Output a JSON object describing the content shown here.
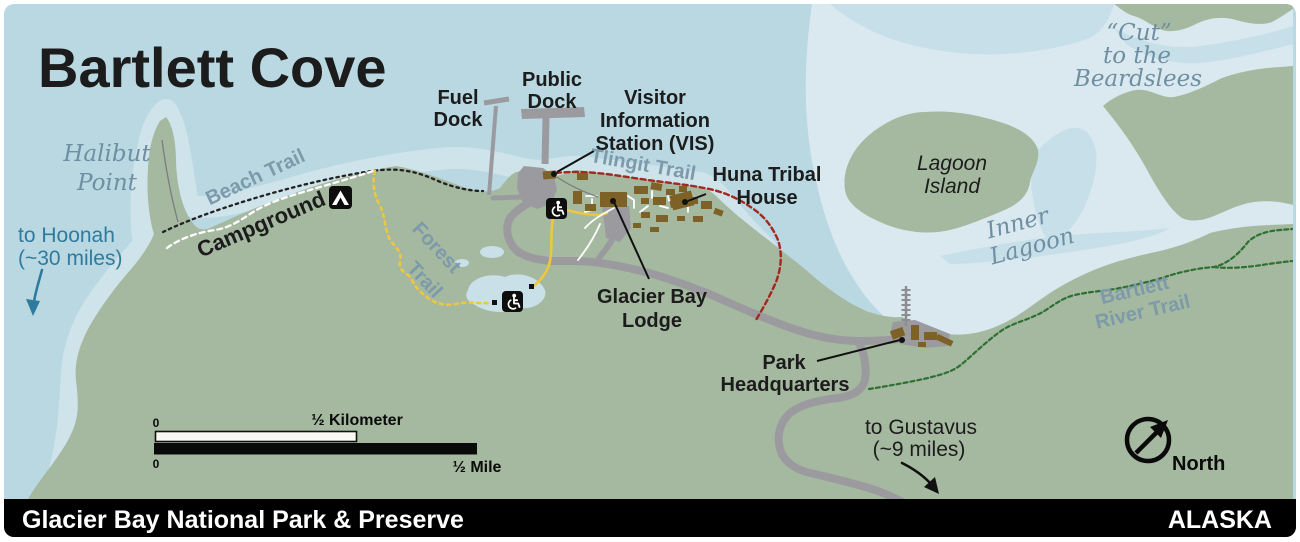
{
  "title": "Bartlett Cove",
  "footer": {
    "park": "Glacier Bay National Park & Preserve",
    "state": "ALASKA"
  },
  "places": {
    "halibut_point": {
      "line1": "Halibut",
      "line2": "Point"
    },
    "fuel_dock": {
      "line1": "Fuel",
      "line2": "Dock"
    },
    "public_dock": {
      "line1": "Public",
      "line2": "Dock"
    },
    "visitor_station": {
      "line1": "Visitor",
      "line2": "Information",
      "line3": "Station (VIS)"
    },
    "huna_tribal_house": {
      "line1": "Huna Tribal",
      "line2": "House"
    },
    "glacier_bay_lodge": {
      "line1": "Glacier Bay",
      "line2": "Lodge"
    },
    "park_headquarters": {
      "line1": "Park",
      "line2": "Headquarters"
    },
    "campground": {
      "label": "Campground"
    },
    "lagoon_island": {
      "line1": "Lagoon",
      "line2": "Island"
    },
    "inner_lagoon": {
      "line1": "Inner",
      "line2": "Lagoon"
    },
    "cut_to_beardslees": {
      "line1": "“Cut”",
      "line2": "to the",
      "line3": "Beardslees"
    }
  },
  "trails": {
    "beach_trail": "Beach Trail",
    "forest_trail": {
      "line1": "Forest",
      "line2": "Trail"
    },
    "tlingit_trail": "Tlingit Trail",
    "bartlett_river_trail": {
      "line1": "Bartlett",
      "line2": "River Trail"
    }
  },
  "directions": {
    "to_hoonah": {
      "line1": "to Hoonah",
      "line2": "(~30 miles)"
    },
    "to_gustavus": {
      "line1": "to Gustavus",
      "line2": "(~9 miles)"
    }
  },
  "scale_bar": {
    "zero_top": "0",
    "zero_bottom": "0",
    "km_label": "½ Kilometer",
    "mile_label": "½ Mile"
  },
  "compass": {
    "label": "North"
  },
  "icons": {
    "campground": "tent-icon",
    "accessible_upper": "wheelchair-icon",
    "accessible_lower": "wheelchair-icon",
    "north_arrow": "northeast-arrow-icon",
    "hoonah_arrow": "down-arrow-icon",
    "gustavus_arrow": "curved-arrow-icon"
  },
  "colors": {
    "water": "#b9d8e2",
    "water_pale": "#d9e9ef",
    "water_mid": "#c6dfe8",
    "shallow": "#cfe3ea",
    "pond": "#c9e0e9",
    "land": "#a5b9a0",
    "road": "#9b9b9f",
    "building": "#7d6126",
    "trail_red": "#a3281f",
    "trail_yellow": "#edc73e",
    "trail_green": "#2e7033",
    "trail_black": "#222222",
    "trail_white": "#ffffff",
    "label_slate": "#7d9aab",
    "label_water": "#6f8fa3",
    "label_teal": "#2f7b9e",
    "text_dark": "#1c1c1c",
    "footer_bg": "#000000",
    "footer_text": "#ffffff"
  }
}
